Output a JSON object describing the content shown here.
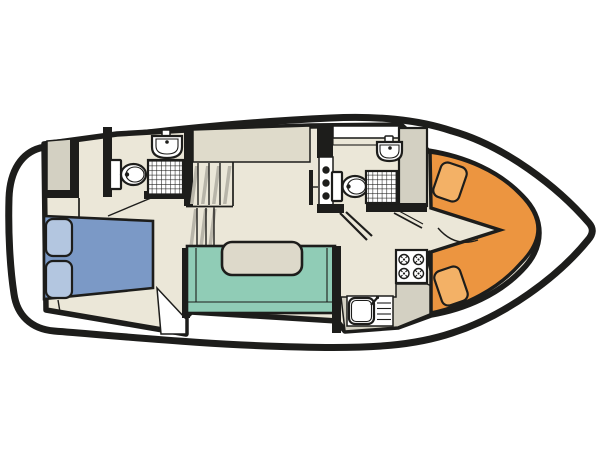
{
  "diagram": {
    "type": "boat-deck-floor-plan",
    "description": "Top-down interior layout plan of a motor cruiser, bow to the right"
  },
  "colors": {
    "wall": "#1d1d1b",
    "hull_outline": "#1d1d1b",
    "deck": "#ffffff",
    "floor": "#ebe7d8",
    "console": "#dfdbcb",
    "cabinet": "#d3d0c2",
    "stair_hatch": "#b8b5a9",
    "fixture": "#ffffff",
    "bed": "#7b99c6",
    "pillow": "#b3c6e0",
    "sofa": "#90ccb6",
    "table": "#ddd9ca",
    "bow_seat": "#ec9540",
    "bow_cushion": "#f3b166"
  },
  "rooms": {
    "aft_cabin": {
      "name": "aft cabin",
      "items": [
        "double-bed",
        "pillow",
        "pillow",
        "wardrobe"
      ]
    },
    "aft_bathroom": {
      "name": "aft bathroom",
      "items": [
        "toilet",
        "washbasin",
        "shower"
      ]
    },
    "saloon": {
      "name": "saloon",
      "items": [
        "stairs",
        "u-sofa",
        "table"
      ]
    },
    "forward_bathroom": {
      "name": "forward bathroom",
      "items": [
        "toilet",
        "washbasin",
        "shower"
      ]
    },
    "galley": {
      "name": "galley",
      "items": [
        "stove",
        "sink-with-drainboard",
        "counter"
      ]
    },
    "bow_dinette": {
      "name": "bow dinette",
      "items": [
        "v-seating",
        "cushion",
        "cushion"
      ]
    }
  },
  "counts": {
    "stove_burners": 4,
    "wall_dots": 3,
    "stair_flights": 2,
    "bathrooms": 2
  }
}
